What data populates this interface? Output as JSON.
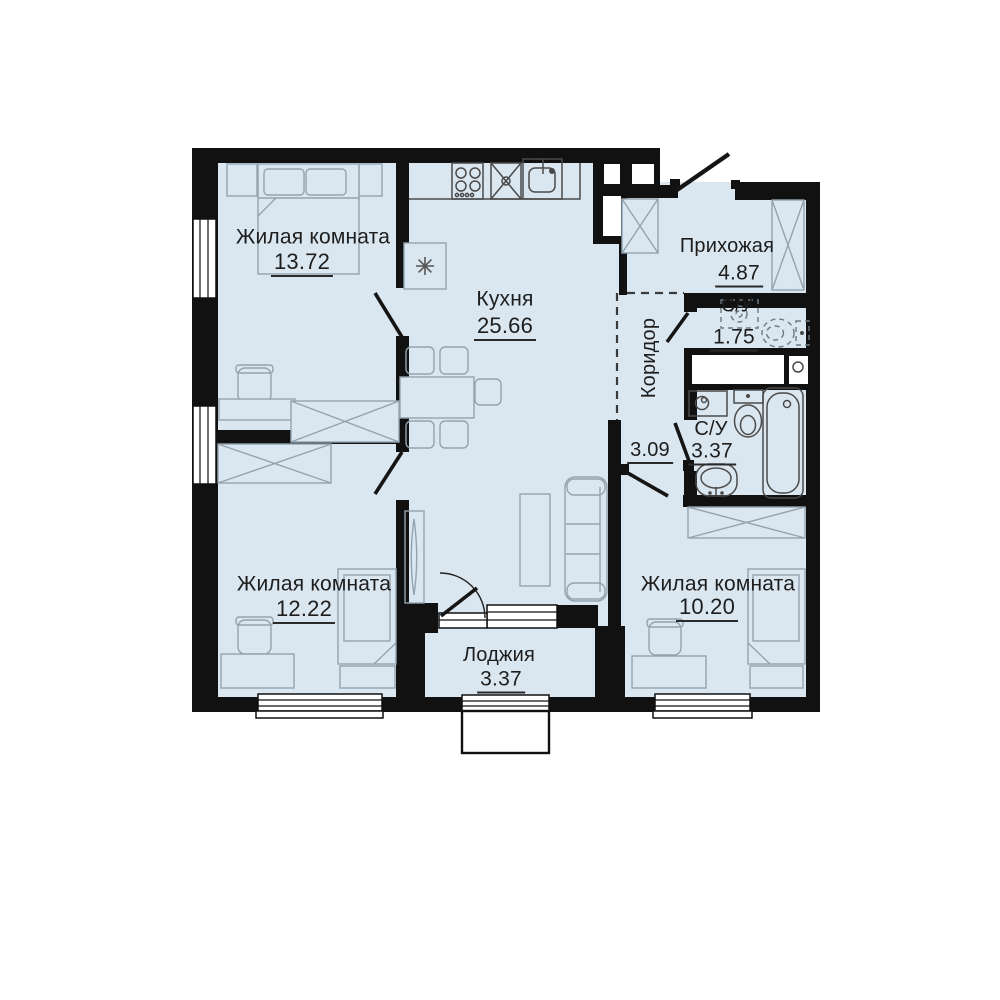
{
  "plan_title": "3-room apartment floor plan",
  "colors": {
    "floor": "#dbe7f0",
    "wall": "#111111",
    "furniture_line": "#93a3ae",
    "fixture_line": "#4a4a4a",
    "text": "#1d1d1d"
  },
  "rooms": [
    {
      "name": "Жилая комната",
      "area": "13.72"
    },
    {
      "name": "Кухня",
      "area": "25.66"
    },
    {
      "name": "Прихожая",
      "area": "4.87"
    },
    {
      "name": "С/У",
      "area": "1.75"
    },
    {
      "name": "Коридор",
      "area": "3.09"
    },
    {
      "name": "С/У",
      "area": "3.37"
    },
    {
      "name": "Жилая комната",
      "area": "12.22"
    },
    {
      "name": "Жилая комната",
      "area": "10.20"
    },
    {
      "name": "Лоджия",
      "area": "3.37"
    }
  ]
}
